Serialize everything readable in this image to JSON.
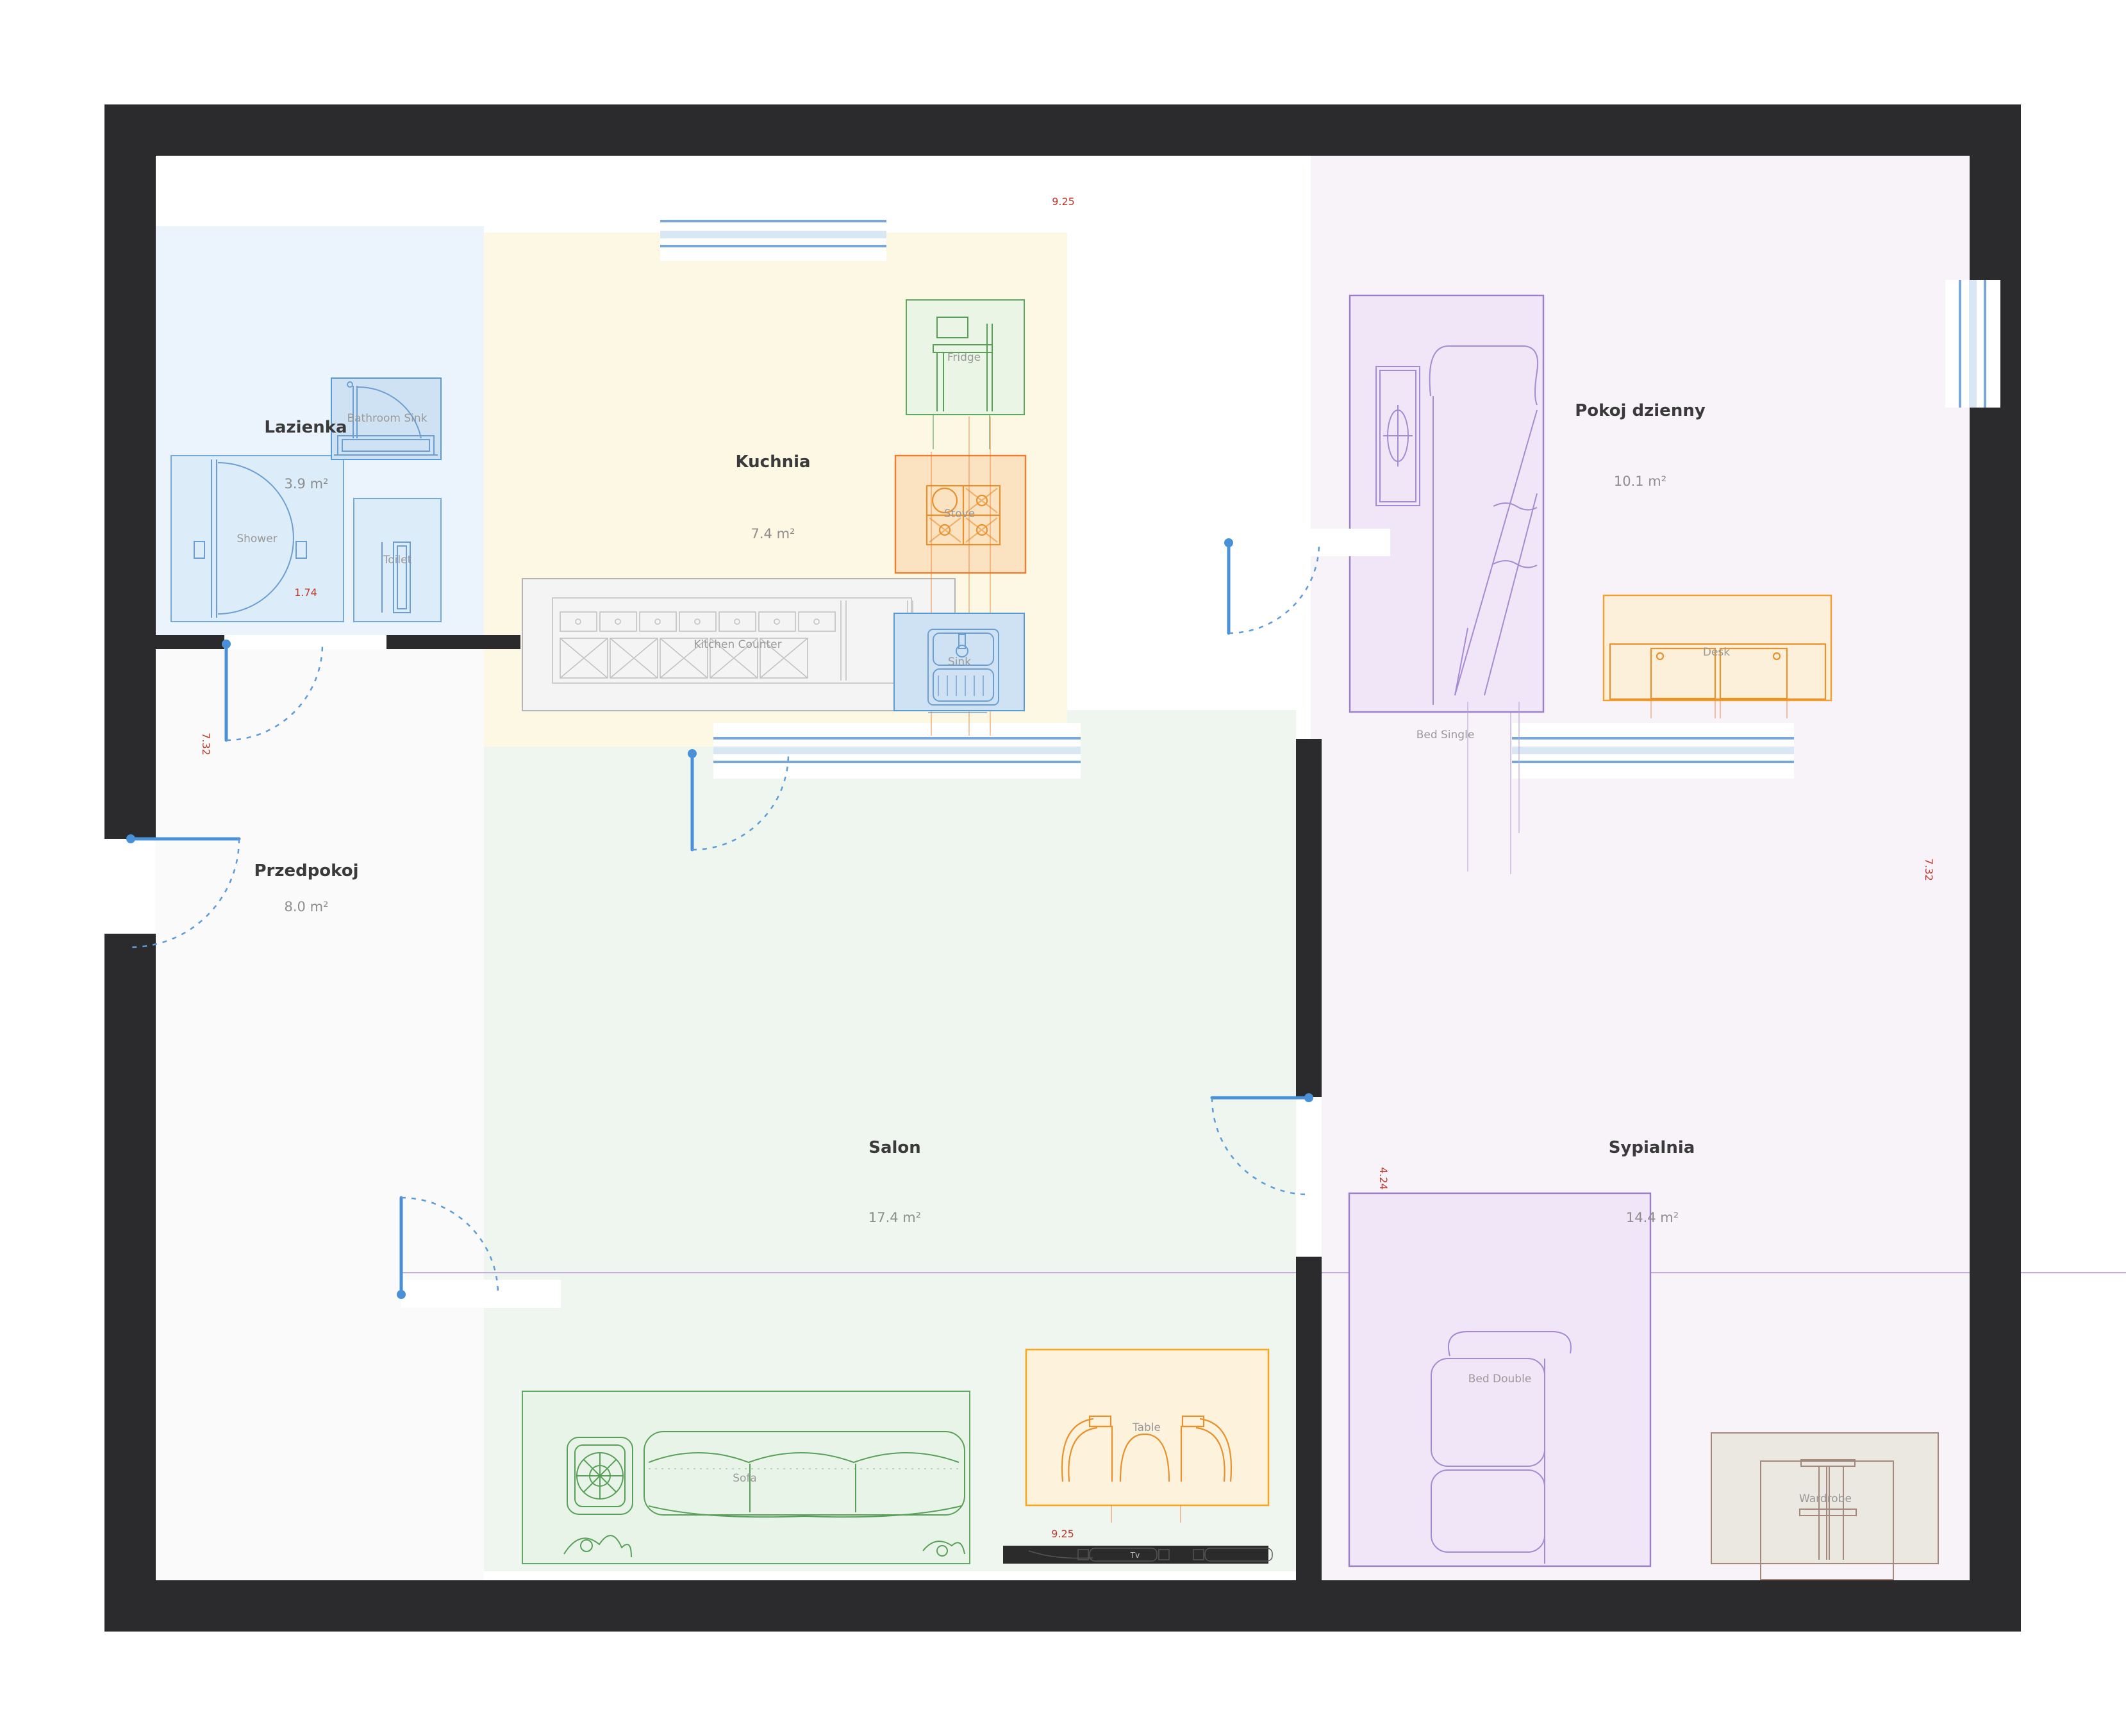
{
  "plan": {
    "rooms": {
      "bathroom": {
        "name": "Lazienka",
        "area": "3.9 m²"
      },
      "kitchen": {
        "name": "Kuchnia",
        "area": "7.4 m²"
      },
      "living": {
        "name": "Pokoj dzienny",
        "area": "10.1 m²"
      },
      "hallway": {
        "name": "Przedpokoj",
        "area": "8.0 m²"
      },
      "salon": {
        "name": "Salon",
        "area": "17.4 m²"
      },
      "bedroom": {
        "name": "Sypialnia",
        "area": "14.4 m²"
      }
    },
    "furniture": {
      "bathroom_sink": "Bathroom Sink",
      "shower": "Shower",
      "toilet": "Toilet",
      "fridge": "Fridge",
      "stove": "Stove",
      "sink": "Sink",
      "kitchen_counter": "Kitchen Counter",
      "bed_single": "Bed Single",
      "desk": "Desk",
      "bed_double": "Bed Double",
      "wardrobe": "Wardrobe",
      "sofa": "Sofa",
      "table": "Table",
      "tv": "Tv"
    },
    "dimensions": {
      "width_top": "9.25",
      "width_bottom": "9.25",
      "height_left": "7.32",
      "height_right": "7.32",
      "bathroom_width": "1.74",
      "bedroom_height": "4.24"
    },
    "colors": {
      "wall": "#2b2b2d",
      "door": "#4a90d9",
      "window_frame": "#7aa7d9",
      "dimension_red": "#c0392b",
      "bathroom_fill": "#ebf4fc",
      "kitchen_fill": "#fdf8e3",
      "salon_fill": "#eef6ef",
      "hallway_fill": "#fafafa",
      "lavender_fill": "#f8f3f9",
      "blue_item": "#5b9bd5",
      "green_item": "#5fa85f",
      "orange_item": "#ed7d31",
      "purple_item": "#9b7fc7",
      "brown_item": "#a3887b"
    }
  }
}
